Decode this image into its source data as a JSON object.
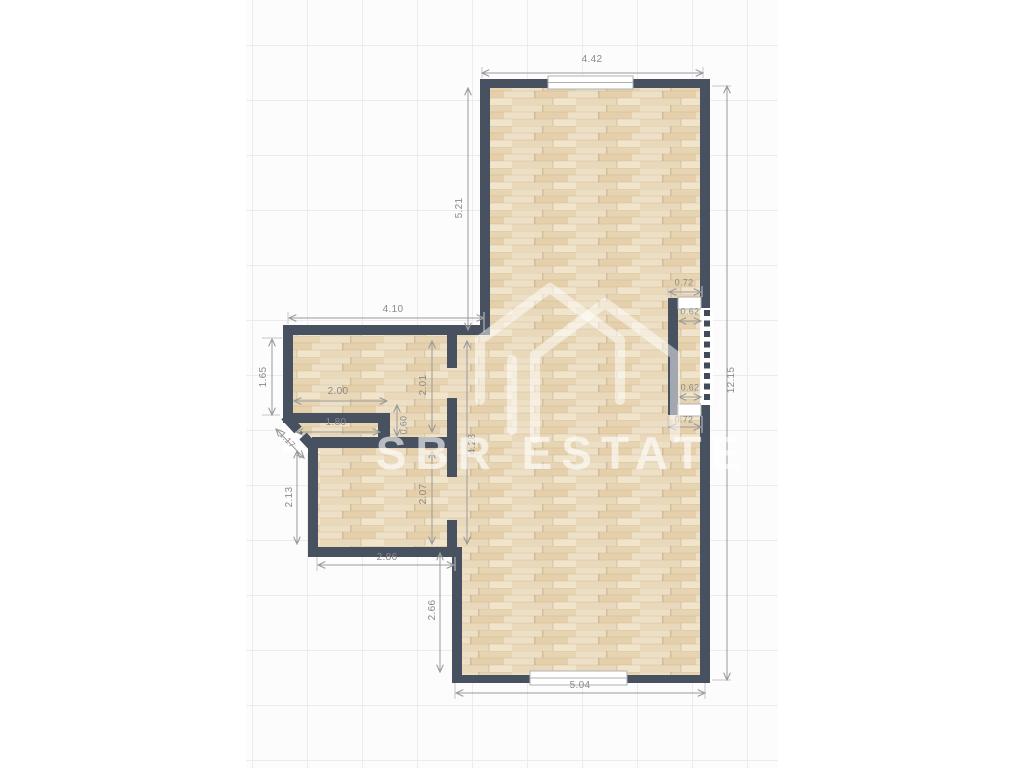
{
  "brand": {
    "name": "SBR ESTATE"
  },
  "colors": {
    "wall": "#475160",
    "floor": "#e9d8b9",
    "dim": "#8a8a8a",
    "grid": "#ececec"
  },
  "dims": {
    "top_width": "4.42",
    "tall_room_height": "5.21",
    "right_total": "12.15",
    "niche_top": "0.72",
    "niche_window_top": "0.62",
    "niche_window_bottom": "0.62",
    "niche_bottom": "0.72",
    "wing_width": "4.10",
    "small_room_depth": "1.65",
    "small_room_width": "2.00",
    "hall_width": "1.80",
    "hall_passage": "0.60",
    "inner_upper": "2.01",
    "inner_lower": "2.07",
    "corridor_height": "4.28",
    "entry_door": "1.17",
    "lower_room_depth": "2.13",
    "lower_room_width": "2.86",
    "bottom_height": "2.66",
    "bottom_width": "5.04"
  }
}
